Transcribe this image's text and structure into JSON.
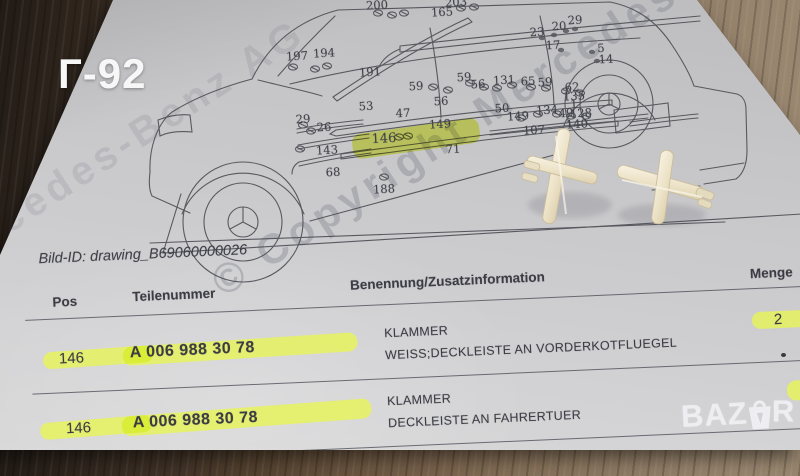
{
  "overlay": {
    "corner_label": "Г-92"
  },
  "watermark": {
    "line1": "© Copyright Mercedes-Benz AG",
    "line2": "Mercedes-Benz AG"
  },
  "document": {
    "bild_id": "Bild-ID: drawing_B69060000026",
    "table": {
      "headers": {
        "pos": "Pos",
        "teilenummer": "Teilenummer",
        "benennung": "Benennung/Zusatzinformation",
        "menge": "Menge"
      },
      "rows": [
        {
          "pos": "146",
          "teilenummer": "A 006 988 30 78",
          "name": "KLAMMER",
          "info": "WEISS;DECKLEISTE AN VORDERKOTFLUEGEL",
          "menge": "2"
        },
        {
          "pos": "146",
          "teilenummer": "A 006 988 30 78",
          "name": "KLAMMER",
          "info": "DECKLEISTE AN FAHRERTUER",
          "menge": ""
        }
      ]
    }
  },
  "diagram": {
    "highlighted_part": "146",
    "labels": [
      {
        "t": "200",
        "x": 377,
        "y": 5
      },
      {
        "t": "203",
        "x": 456,
        "y": 2
      },
      {
        "t": "165",
        "x": 442,
        "y": 12
      },
      {
        "t": "197",
        "x": 297,
        "y": 56
      },
      {
        "t": "194",
        "x": 324,
        "y": 53
      },
      {
        "t": "191",
        "x": 370,
        "y": 72
      },
      {
        "t": "23",
        "x": 537,
        "y": 32
      },
      {
        "t": "20",
        "x": 559,
        "y": 26
      },
      {
        "t": "29",
        "x": 575,
        "y": 20
      },
      {
        "t": "17",
        "x": 553,
        "y": 45
      },
      {
        "t": "5",
        "x": 601,
        "y": 48
      },
      {
        "t": "14",
        "x": 606,
        "y": 59
      },
      {
        "t": "59",
        "x": 416,
        "y": 86
      },
      {
        "t": "59",
        "x": 464,
        "y": 77
      },
      {
        "t": "56",
        "x": 441,
        "y": 101
      },
      {
        "t": "56",
        "x": 478,
        "y": 84
      },
      {
        "t": "131",
        "x": 504,
        "y": 80
      },
      {
        "t": "65",
        "x": 528,
        "y": 81
      },
      {
        "t": "59",
        "x": 545,
        "y": 82
      },
      {
        "t": "62",
        "x": 572,
        "y": 87
      },
      {
        "t": "135",
        "x": 574,
        "y": 96
      },
      {
        "t": "53",
        "x": 366,
        "y": 106
      },
      {
        "t": "47",
        "x": 403,
        "y": 113
      },
      {
        "t": "149",
        "x": 440,
        "y": 124
      },
      {
        "t": "50",
        "x": 502,
        "y": 108
      },
      {
        "t": "149",
        "x": 518,
        "y": 116
      },
      {
        "t": "134",
        "x": 547,
        "y": 110
      },
      {
        "t": "49",
        "x": 566,
        "y": 113
      },
      {
        "t": "1",
        "x": 574,
        "y": 104
      },
      {
        "t": "128",
        "x": 581,
        "y": 113
      },
      {
        "t": "107",
        "x": 534,
        "y": 130
      },
      {
        "t": "140",
        "x": 577,
        "y": 124
      },
      {
        "t": "29",
        "x": 303,
        "y": 119
      },
      {
        "t": "26",
        "x": 324,
        "y": 127
      },
      {
        "t": "143",
        "x": 327,
        "y": 150
      },
      {
        "t": "68",
        "x": 333,
        "y": 172
      },
      {
        "t": "188",
        "x": 384,
        "y": 189
      },
      {
        "t": "71",
        "x": 453,
        "y": 149
      },
      {
        "t": "146",
        "x": 384,
        "y": 139,
        "hl": true
      }
    ]
  },
  "logo": {
    "full": "BAZAR",
    "part1": "BAZ",
    "part2": "R"
  },
  "colors": {
    "highlight": "#e7f455",
    "paper": "#cbcbcd",
    "ink": "#4a4a52",
    "clip_plastic": "#ece3cb",
    "wood_dark": "#30261e",
    "wood_light": "#9c8a73"
  }
}
